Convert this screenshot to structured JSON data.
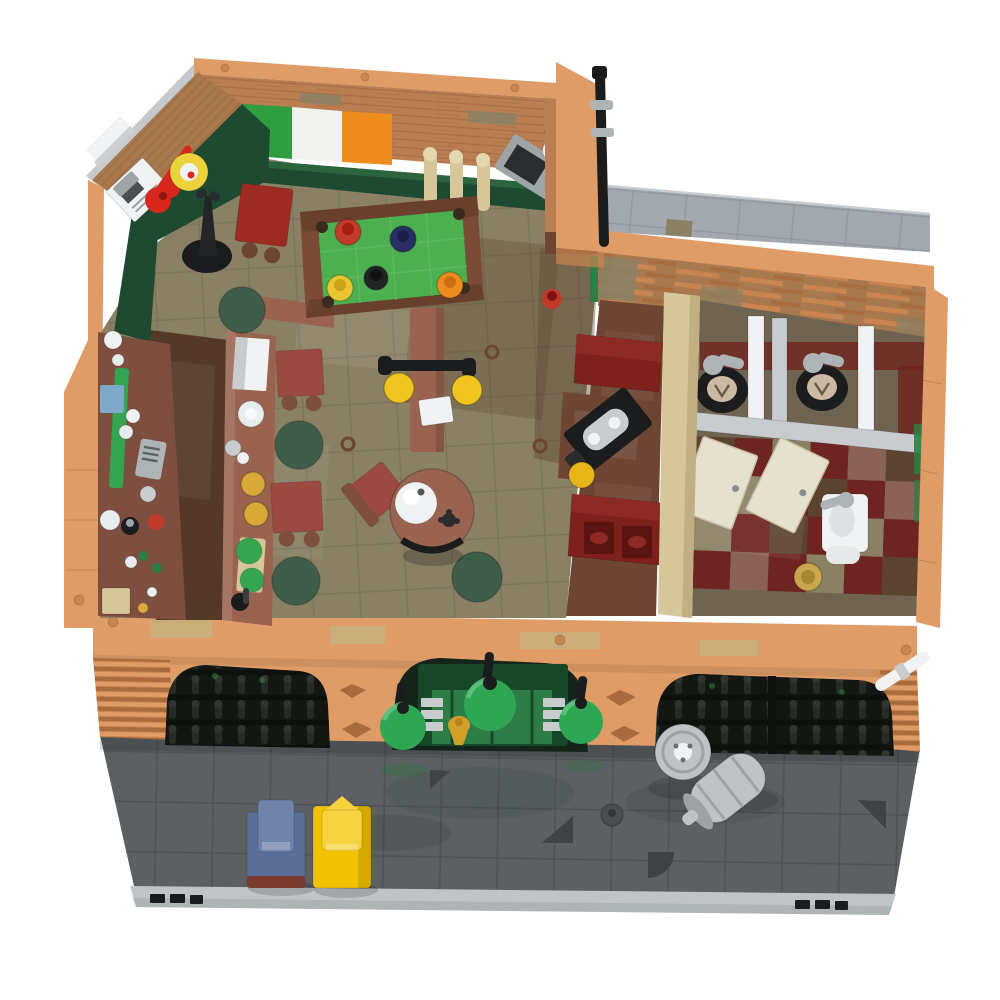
{
  "scene": {
    "title": "LEGO modular Irish pub — top-down interior render on white background",
    "view": "bird's-eye interior cutaway, street side at bottom"
  },
  "labels": {
    "scene": "LEGO Irish pub render",
    "pub_room": "Pub main room",
    "pool_table": "Pool table with balls",
    "bar_counter": "Bar counter with mugs and plates",
    "bottle_shelf": "Back-bar bottle shelf",
    "irish_flag": "Irish flag on brick wall",
    "dartboard": "Dartboard",
    "guitar": "Red guitar on wall",
    "poster": "Framed picture",
    "coat_stand": "Black coat stand",
    "beer_taps": "Three cream beer tap pillars",
    "tv": "Corner TV with lamp",
    "round_table": "Round table with globe lamp",
    "booth_room": "Snug room with red booths",
    "gramophone": "Gramophone on booth table",
    "bathroom": "Restroom with two stalls",
    "toilet": "Toilet",
    "stall_door": "Open stall door",
    "sink": "Wash basin",
    "floor_drain": "Floor drain",
    "facade": "Brick street facade with three arches",
    "entrance": "Green pub entrance",
    "dome_lamp": "Green dome lamp",
    "arch_window": "Arched lattice window",
    "keg_upright": "Upright beer keg",
    "keg_lying": "Tipped beer keg",
    "street": "Grey street with parked cars",
    "car_blue": "Blue car",
    "car_yellow": "Yellow car",
    "roof": "Flat grey roof terrace",
    "drainpipe": "Black drainpipe",
    "manhole": "Street drain cover"
  },
  "colors": {
    "bg": "#FFFFFF",
    "nougat": "#DF9C66",
    "nougat_dark": "#C9844F",
    "nougat_deep": "#A96A3C",
    "tan": "#D6C79A",
    "tan_dark": "#BBA87C",
    "olive_tile": "#C8B07C",
    "brick": "#BB7E52",
    "brick_line": "#8F5E3C",
    "wood": "#A8784E",
    "wood_line": "#8F6238",
    "flag_green": "#2F9E41",
    "flag_white": "#F2F2F0",
    "flag_orange": "#EE8C1E",
    "dark_green": "#1E4A31",
    "door_green": "#2E7D46",
    "door_green_deep": "#17482A",
    "dome": "#2FA653",
    "dome_deep": "#1E7A3A",
    "felt": "#4CAF50",
    "felt_line": "#6ABE6E",
    "pool_frame": "#7B4B35",
    "pool_apron": "#5E3A28",
    "floor": "#8A8164",
    "floor_line": "#6E6750",
    "bar_floor": "#543A26",
    "counter": "#9A6350",
    "counter_dark": "#7E4E3E",
    "maroon": "#9C4A41",
    "stool": "#3F5D4B",
    "stool_ring": "#2F4638",
    "booth": "#7E211C",
    "booth_deep": "#5C1411",
    "booth_seat": "#8E2A24",
    "booth_table": "#6E4533",
    "backsplash": "#70241E",
    "silver": "#C9CCCE",
    "silver_deep": "#9FA4A7",
    "white": "#F0F2F3",
    "black": "#1B1C1D",
    "street": "#5C6063",
    "street_line": "#4B4F52",
    "street_mark": "#3F4346",
    "curb": "#C0C4C6",
    "curb_deep": "#A7ACAF",
    "roof": "#A2A8AD",
    "roof_line": "#8C9298",
    "checker_red": "#6E2420",
    "checker_mauve": "#8A6258",
    "checker_brown": "#5C4330",
    "car_blue": "#5A6E96",
    "car_blue_top": "#6F82A8",
    "mudguard": "#7A3B2E",
    "car_yellow": "#F2C100",
    "car_yellow_top": "#F6D23F",
    "mug": "#D9A937",
    "lamp": "#F2C41F",
    "dart": "#EDD33B",
    "dart_ring": "#C9A54B",
    "guitar": "#D8271C",
    "keg": "#C0C3C5",
    "keg_deep": "#9EA2A5",
    "gold": "#D2A028",
    "tank": "#AEB4B6",
    "lid": "#CBB9A1",
    "glass": "#E7ECEE",
    "green_item": "#35A552",
    "red_item": "#C23B2A",
    "blue_item": "#7FA8C9",
    "door_cream": "#E6E0CF",
    "gramo_lamp": "#E8B519",
    "wall_gray": "#C3C9CD"
  }
}
